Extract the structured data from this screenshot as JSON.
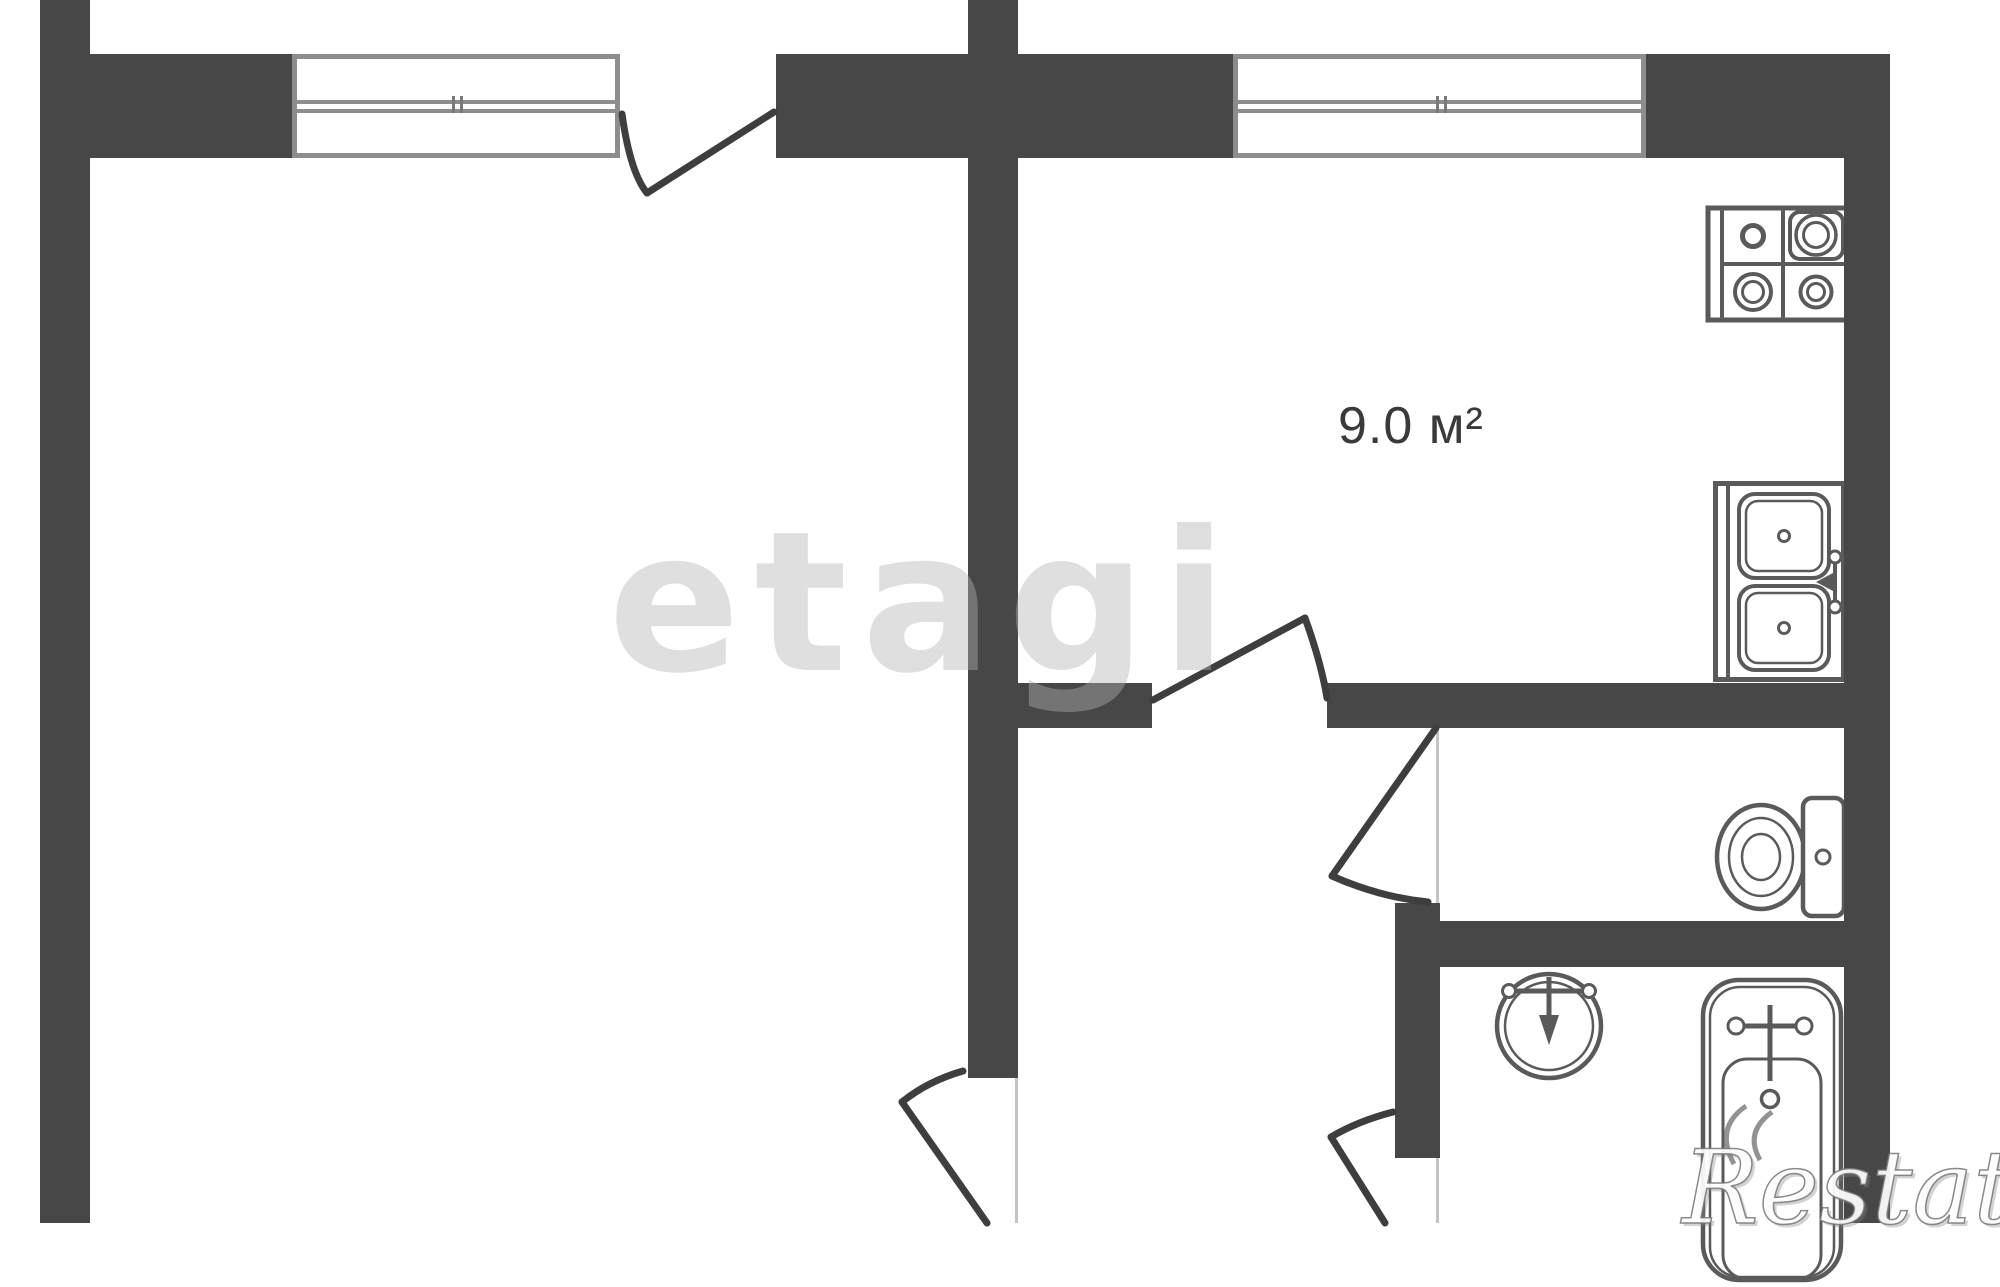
{
  "plan": {
    "type": "apartment-floor-plan",
    "area_label": "9.0 м²",
    "rooms": [
      {
        "name": "kitchen",
        "area_m2": "9.0"
      },
      {
        "name": "living-room",
        "area_m2": ""
      },
      {
        "name": "toilet",
        "area_m2": ""
      },
      {
        "name": "bathroom",
        "area_m2": ""
      },
      {
        "name": "hallway",
        "area_m2": ""
      }
    ],
    "fixture_icons": [
      "stove-icon",
      "kitchen-double-sink-icon",
      "toilet-icon",
      "wash-basin-icon",
      "bathtub-icon"
    ],
    "opening_icons": [
      "window-icon",
      "door-swing-icon"
    ]
  },
  "watermarks": {
    "center": "etagi",
    "corner": "Restate"
  },
  "colors": {
    "wall": "#474747",
    "line": "#3e3e3e",
    "fixture": "#5a5a5a",
    "window_frame": "#8d8d8d",
    "jamb": "#c4c4c4",
    "background": "#ffffff",
    "watermark": "#b4b4b4",
    "label": "#3a3a3a"
  }
}
